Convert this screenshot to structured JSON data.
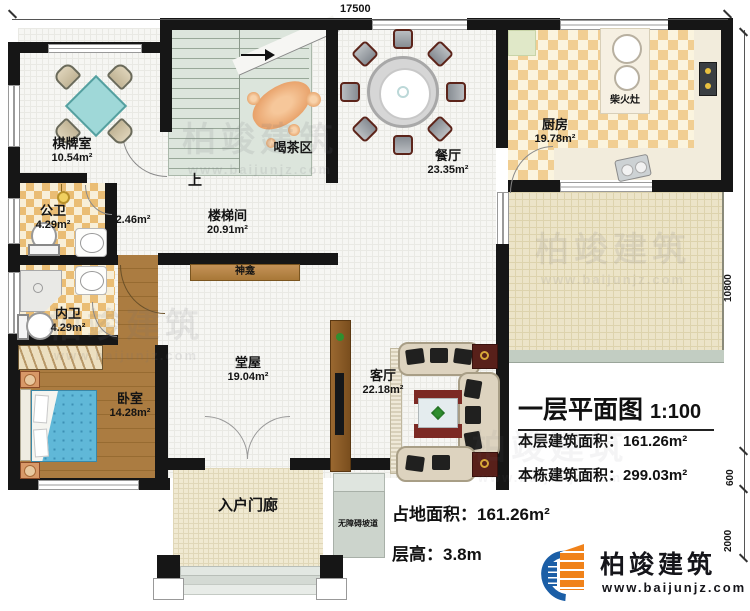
{
  "dimensions": {
    "top": "17500",
    "right_total": "10800",
    "right_mid": "600",
    "right_bottom": "2000"
  },
  "rooms": {
    "chess": {
      "name": "棋牌室",
      "area": "10.54m²"
    },
    "stairwell": {
      "name": "楼梯间",
      "area": "20.91m²"
    },
    "stair_up": "上",
    "corridor_area": "2.46m²",
    "tea": {
      "name": "喝茶区"
    },
    "dining": {
      "name": "餐厅",
      "area": "23.35m²"
    },
    "kitchen": {
      "name": "厨房",
      "area": "19.78m²"
    },
    "wood_stove": "柴火灶",
    "public_wc": {
      "name": "公卫",
      "area": "4.29m²"
    },
    "private_wc": {
      "name": "内卫",
      "area": "4.29m²"
    },
    "bedroom": {
      "name": "卧室",
      "area": "14.28m²"
    },
    "hall": {
      "name": "堂屋",
      "area": "19.04m²"
    },
    "shrine": "神龛",
    "living": {
      "name": "客厅",
      "area": "22.18m²"
    },
    "porch": {
      "name": "入户门廊"
    },
    "ramp": {
      "name": "无障碍坡道"
    }
  },
  "title_block": {
    "title": "一层平面图",
    "scale": "1:100",
    "floor_area_label": "本层建筑面积：",
    "floor_area_value": "161.26m²",
    "total_area_label": "本栋建筑面积：",
    "total_area_value": "299.03m²",
    "site_area_label": "占地面积：",
    "site_area_value": "161.26m²",
    "storey_height_label": "层高：",
    "storey_height_value": "3.8m"
  },
  "brand": {
    "name": "柏竣建筑",
    "website": "www.baijunjz.com"
  },
  "watermark": {
    "name": "柏竣建筑",
    "website": "www.baijunjz.com"
  },
  "colors": {
    "wall": "#161616",
    "checker_orange": "#eabd74",
    "wood": "#a9793f",
    "bed_blue": "#60b8d8",
    "terrace": "#ece4c8",
    "brand_blue": "#1b5ea6",
    "brand_orange": "#f0821a"
  }
}
